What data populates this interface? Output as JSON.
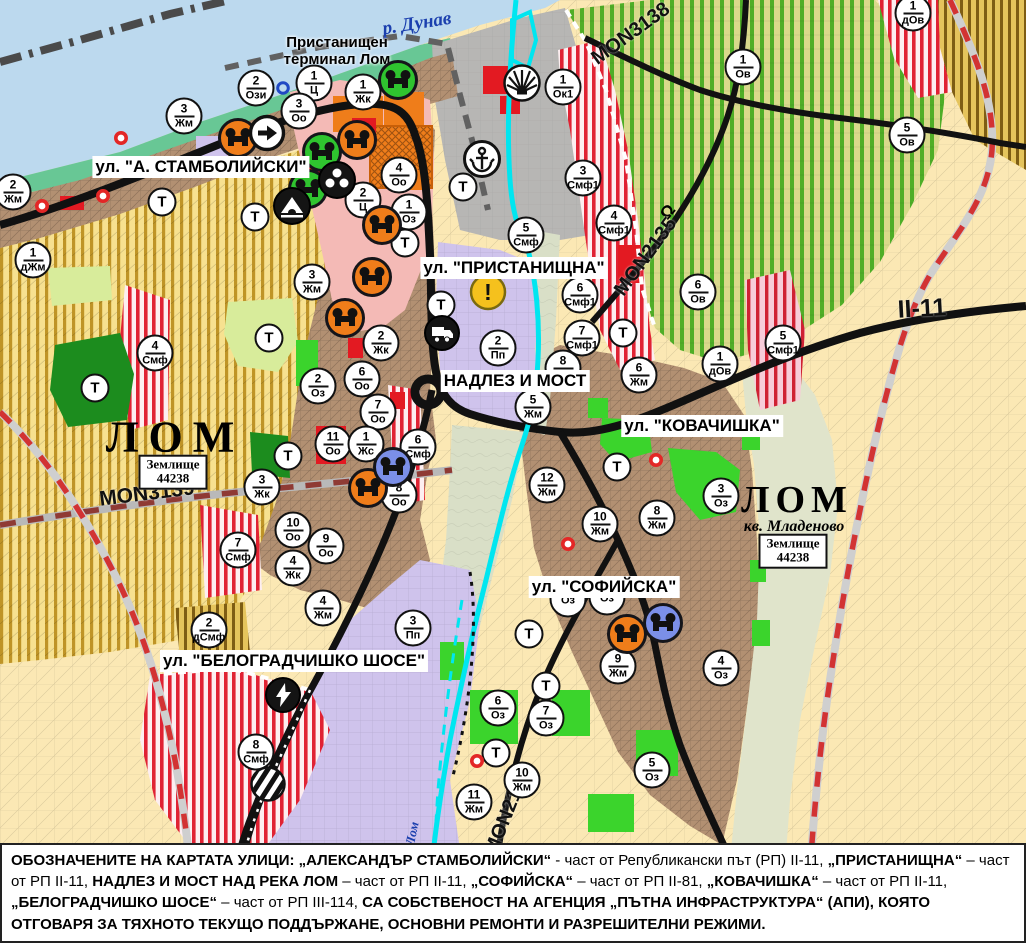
{
  "colors": {
    "water": "#bcd9ee",
    "coast": "#68c795",
    "port_gray": "#b7b6b4",
    "urban_brown": "#b29072",
    "pink_center": "#f4bab6",
    "violet_industrial": "#cfc3ec",
    "farm_cream": "#fbe8b4",
    "yellow_stripe": "#bf9427",
    "green_stripe": "#4fae27",
    "red_stripe": "#e02233",
    "bright_green": "#3bd42c",
    "dark_green": "#1c8c1e",
    "river_cyan": "#00e6f0",
    "road_black": "#111111",
    "red_solid": "#e31a22",
    "orange": "#ef7d1a",
    "warning_yellow": "#f5c11d",
    "marker_border": "#111111",
    "river_label_blue": "#1b3fae"
  },
  "map": {
    "street_labels": [
      {
        "text": "ул. \"А. СТАМБОЛИЙСКИ\"",
        "x": 201,
        "y": 167
      },
      {
        "text": "ул. \"ПРИСТАНИЩНА\"",
        "x": 514,
        "y": 268
      },
      {
        "text": "НАДЛЕЗ И МОСТ",
        "x": 515,
        "y": 381
      },
      {
        "text": "ул. \"КОВАЧИШКА\"",
        "x": 702,
        "y": 426
      },
      {
        "text": "ул. \"СОФИЙСКА\"",
        "x": 604,
        "y": 587
      },
      {
        "text": "ул. \"БЕЛОГРАДЧИШКО ШОСЕ\"",
        "x": 294,
        "y": 661
      }
    ],
    "place_labels": [
      {
        "text": "р. Дунав",
        "x": 417,
        "y": 24,
        "rot": -9,
        "cls": "pl-river",
        "name": "danube-river-label"
      },
      {
        "text": "Пристанищен\nтерминал Лом",
        "x": 337,
        "y": 51,
        "rot": 0,
        "cls": "pl-terminal",
        "name": "port-terminal-label"
      },
      {
        "text": "ЛОМ",
        "x": 175,
        "y": 437,
        "rot": 0,
        "cls": "pl-city",
        "fs": 44,
        "ls": 10,
        "name": "lom-city-label-west"
      },
      {
        "text": "ЛОМ",
        "x": 797,
        "y": 500,
        "rot": 0,
        "cls": "pl-city",
        "fs": 38,
        "ls": 6,
        "name": "lom-city-label-east"
      },
      {
        "text": "кв. Младеново",
        "x": 794,
        "y": 527,
        "rot": 0,
        "cls": "pl-suburb",
        "name": "mladenovo-quarter-label"
      },
      {
        "text": "р. Лом",
        "x": 411,
        "y": 840,
        "rot": -78,
        "cls": "pl-riverv",
        "name": "lom-river-label"
      },
      {
        "text": "Ω",
        "x": 668,
        "y": 212,
        "rot": -50,
        "cls": "pl-bridgesym",
        "name": "bridge-symbol"
      }
    ],
    "land_boxes": [
      {
        "line1": "Землище",
        "line2": "44238",
        "x": 173,
        "y": 472
      },
      {
        "line1": "Землище",
        "line2": "44238",
        "x": 793,
        "y": 551
      }
    ],
    "road_labels": [
      {
        "text": "MON3138",
        "x": 631,
        "y": 34,
        "rot": -36,
        "fs": 20
      },
      {
        "text": "MON2135",
        "x": 646,
        "y": 257,
        "rot": -54,
        "fs": 20
      },
      {
        "text": "MON3139",
        "x": 147,
        "y": 494,
        "rot": -7,
        "fs": 21
      },
      {
        "text": "MON2136",
        "x": 508,
        "y": 812,
        "rot": -68,
        "fs": 20
      },
      {
        "text": "II-11",
        "x": 922,
        "y": 309,
        "rot": -3,
        "fs": 25
      }
    ],
    "t_label": "Т",
    "zone_markers": [
      {
        "n": "2",
        "c": "Ози",
        "x": 256,
        "y": 88
      },
      {
        "n": "1",
        "c": "Ц",
        "x": 314,
        "y": 83
      },
      {
        "n": "1",
        "c": "Жк",
        "x": 363,
        "y": 92
      },
      {
        "n": "3",
        "c": "Оо",
        "x": 299,
        "y": 111
      },
      {
        "n": "1",
        "c": "Ок1",
        "x": 563,
        "y": 87
      },
      {
        "n": "3",
        "c": "Жм",
        "x": 184,
        "y": 116
      },
      {
        "n": "2",
        "c": "Жм",
        "x": 13,
        "y": 192
      },
      {
        "n": "1",
        "c": "дЖм",
        "x": 33,
        "y": 260
      },
      {
        "n": "4",
        "c": "Оо",
        "x": 399,
        "y": 175
      },
      {
        "n": "2",
        "c": "Ц",
        "x": 363,
        "y": 200
      },
      {
        "n": "1",
        "c": "Оз",
        "x": 409,
        "y": 212
      },
      {
        "n": "3",
        "c": "Жм",
        "x": 312,
        "y": 282
      },
      {
        "n": "5",
        "c": "Смф",
        "x": 526,
        "y": 235
      },
      {
        "n": "3",
        "c": "Смф1",
        "x": 583,
        "y": 178
      },
      {
        "n": "4",
        "c": "Смф1",
        "x": 614,
        "y": 223
      },
      {
        "n": "1",
        "c": "Ов",
        "x": 743,
        "y": 67
      },
      {
        "n": "5",
        "c": "Ов",
        "x": 907,
        "y": 135
      },
      {
        "n": "1",
        "c": "дОв",
        "x": 913,
        "y": 13
      },
      {
        "n": "6",
        "c": "Ов",
        "x": 698,
        "y": 292
      },
      {
        "n": "1",
        "c": "дОв",
        "x": 720,
        "y": 364
      },
      {
        "n": "5",
        "c": "Смф1",
        "x": 783,
        "y": 343
      },
      {
        "n": "6",
        "c": "Смф1",
        "x": 580,
        "y": 295
      },
      {
        "n": "7",
        "c": "Смф1",
        "x": 582,
        "y": 338
      },
      {
        "n": "8",
        "c": "Жм",
        "x": 563,
        "y": 368
      },
      {
        "n": "6",
        "c": "Жм",
        "x": 639,
        "y": 375
      },
      {
        "n": "5",
        "c": "Жм",
        "x": 533,
        "y": 407
      },
      {
        "n": "2",
        "c": "Пп",
        "x": 498,
        "y": 348
      },
      {
        "n": "4",
        "c": "Смф",
        "x": 155,
        "y": 353
      },
      {
        "n": "2",
        "c": "Жк",
        "x": 381,
        "y": 343
      },
      {
        "n": "2",
        "c": "Оз",
        "x": 318,
        "y": 386
      },
      {
        "n": "6",
        "c": "Оо",
        "x": 362,
        "y": 379
      },
      {
        "n": "7",
        "c": "Оо",
        "x": 378,
        "y": 412
      },
      {
        "n": "11",
        "c": "Оо",
        "x": 333,
        "y": 444
      },
      {
        "n": "1",
        "c": "Жс",
        "x": 366,
        "y": 444
      },
      {
        "n": "6",
        "c": "Смф",
        "x": 418,
        "y": 447
      },
      {
        "n": "8",
        "c": "Оо",
        "x": 399,
        "y": 495
      },
      {
        "n": "3",
        "c": "Жк",
        "x": 262,
        "y": 487
      },
      {
        "n": "10",
        "c": "Оо",
        "x": 293,
        "y": 530
      },
      {
        "n": "9",
        "c": "Оо",
        "x": 326,
        "y": 546
      },
      {
        "n": "4",
        "c": "Жк",
        "x": 293,
        "y": 568
      },
      {
        "n": "7",
        "c": "Смф",
        "x": 238,
        "y": 550
      },
      {
        "n": "4",
        "c": "Жм",
        "x": 323,
        "y": 608
      },
      {
        "n": "2",
        "c": "дСмф",
        "x": 209,
        "y": 630
      },
      {
        "n": "3",
        "c": "Пп",
        "x": 413,
        "y": 628
      },
      {
        "n": "8",
        "c": "Смф",
        "x": 256,
        "y": 752
      },
      {
        "n": "12",
        "c": "Жм",
        "x": 547,
        "y": 485
      },
      {
        "n": "10",
        "c": "Жм",
        "x": 600,
        "y": 524
      },
      {
        "n": "8",
        "c": "Жм",
        "x": 657,
        "y": 518
      },
      {
        "n": "3",
        "c": "Оз",
        "x": 721,
        "y": 496
      },
      {
        "n": "6",
        "c": "Оз",
        "x": 498,
        "y": 708
      },
      {
        "n": "7",
        "c": "Оз",
        "x": 546,
        "y": 718
      },
      {
        "n": "9",
        "c": "Жм",
        "x": 618,
        "y": 666
      },
      {
        "n": "4",
        "c": "Оз",
        "x": 721,
        "y": 668
      },
      {
        "n": "5",
        "c": "Оз",
        "x": 652,
        "y": 770
      },
      {
        "n": "10",
        "c": "Жм",
        "x": 522,
        "y": 780
      },
      {
        "n": "11",
        "c": "Жм",
        "x": 474,
        "y": 802
      },
      {
        "n": "",
        "c": "Оз",
        "x": 568,
        "y": 599
      },
      {
        "n": "",
        "c": "Оз",
        "x": 607,
        "y": 597
      }
    ],
    "t_markers": [
      {
        "x": 162,
        "y": 202
      },
      {
        "x": 255,
        "y": 217
      },
      {
        "x": 269,
        "y": 338
      },
      {
        "x": 95,
        "y": 388
      },
      {
        "x": 288,
        "y": 456
      },
      {
        "x": 405,
        "y": 243
      },
      {
        "x": 463,
        "y": 187
      },
      {
        "x": 441,
        "y": 305
      },
      {
        "x": 623,
        "y": 333
      },
      {
        "x": 617,
        "y": 467
      },
      {
        "x": 529,
        "y": 634
      },
      {
        "x": 546,
        "y": 686
      },
      {
        "x": 496,
        "y": 753
      }
    ],
    "poi_icons": [
      {
        "name": "culture-monument-icon",
        "glyph": "culture",
        "fill": "#ef7d1a",
        "x": 238,
        "y": 138
      },
      {
        "name": "culture-monument-icon",
        "glyph": "culture",
        "fill": "#ef7d1a",
        "x": 357,
        "y": 140
      },
      {
        "name": "culture-monument-icon",
        "glyph": "culture",
        "fill": "#ef7d1a",
        "x": 382,
        "y": 225
      },
      {
        "name": "culture-monument-icon",
        "glyph": "culture",
        "fill": "#ef7d1a",
        "x": 372,
        "y": 277
      },
      {
        "name": "culture-monument-icon",
        "glyph": "culture",
        "fill": "#ef7d1a",
        "x": 345,
        "y": 318
      },
      {
        "name": "culture-monument-icon",
        "glyph": "culture",
        "fill": "#ef7d1a",
        "x": 368,
        "y": 488
      },
      {
        "name": "culture-monument-icon",
        "glyph": "culture",
        "fill": "#ef7d1a",
        "x": 627,
        "y": 634
      },
      {
        "name": "culture-monument-icon",
        "glyph": "culture",
        "fill": "#2fc42f",
        "x": 398,
        "y": 80
      },
      {
        "name": "culture-monument-icon",
        "glyph": "culture",
        "fill": "#2fc42f",
        "x": 322,
        "y": 152
      },
      {
        "name": "culture-monument-icon",
        "glyph": "culture",
        "fill": "#2fc42f",
        "x": 308,
        "y": 189
      },
      {
        "name": "culture-monument-icon",
        "glyph": "culture",
        "fill": "#7b8fe8",
        "x": 393,
        "y": 467
      },
      {
        "name": "culture-monument-icon",
        "glyph": "culture",
        "fill": "#7b8fe8",
        "x": 663,
        "y": 623
      },
      {
        "name": "people-group-icon",
        "glyph": "people",
        "fill": "#141414",
        "x": 337,
        "y": 180
      },
      {
        "name": "cave-monument-icon",
        "glyph": "cave",
        "fill": "#141414",
        "x": 292,
        "y": 206
      },
      {
        "name": "one-way-arrow-icon",
        "glyph": "arrow",
        "fill": "#ffffff",
        "x": 267,
        "y": 133
      },
      {
        "name": "port-anchor-icon",
        "glyph": "anchor",
        "fill": "#ffffff",
        "x": 482,
        "y": 159
      },
      {
        "name": "lighthouse-rays-icon",
        "glyph": "rays",
        "fill": "#ffffff",
        "x": 522,
        "y": 83
      },
      {
        "name": "warning-icon",
        "glyph": "warning",
        "fill": "#f5c11d",
        "x": 488,
        "y": 292,
        "label": "!"
      },
      {
        "name": "truck-terminal-icon",
        "glyph": "truck",
        "fill": "#141414",
        "x": 442,
        "y": 333
      },
      {
        "name": "power-station-icon",
        "glyph": "lightning",
        "fill": "#141414",
        "x": 283,
        "y": 695
      },
      {
        "name": "railway-crossing-icon",
        "glyph": "railcross",
        "fill": "#ffffff",
        "x": 268,
        "y": 784
      },
      {
        "name": "point-of-interest-dot-icon",
        "glyph": "reddot",
        "fill": "#e32726",
        "x": 121,
        "y": 138
      },
      {
        "name": "point-of-interest-dot-icon",
        "glyph": "reddot",
        "fill": "#e32726",
        "x": 103,
        "y": 196
      },
      {
        "name": "point-of-interest-dot-icon",
        "glyph": "reddot",
        "fill": "#e32726",
        "x": 42,
        "y": 206
      },
      {
        "name": "point-of-interest-dot-icon",
        "glyph": "reddot",
        "fill": "#e32726",
        "x": 656,
        "y": 460
      },
      {
        "name": "point-of-interest-dot-icon",
        "glyph": "reddot",
        "fill": "#e32726",
        "x": 568,
        "y": 544
      },
      {
        "name": "point-of-interest-dot-icon",
        "glyph": "reddot",
        "fill": "#e32726",
        "x": 477,
        "y": 761
      },
      {
        "name": "blue-ring-icon",
        "glyph": "bluering",
        "fill": "#2149c4",
        "x": 283,
        "y": 88
      }
    ]
  },
  "caption": {
    "segments": [
      {
        "t": "ОБОЗНАЧЕНИТЕ НА КАРТАТА УЛИЦИ: ",
        "b": 1
      },
      {
        "t": "„АЛЕКСАНДЪР СТАМБОЛИЙСКИ“",
        "b": 1
      },
      {
        "t": " - част от Републикански път (РП) II-11, ",
        "b": 0
      },
      {
        "t": "„ПРИСТАНИЩНА“",
        "b": 1
      },
      {
        "t": " – част от РП II-11, ",
        "b": 0
      },
      {
        "t": "НАДЛЕЗ И МОСТ НАД РЕКА ЛОМ",
        "b": 1
      },
      {
        "t": " – част от РП II-11, ",
        "b": 0
      },
      {
        "t": "„СОФИЙСКА“",
        "b": 1
      },
      {
        "t": " – част от РП II-81, ",
        "b": 0
      },
      {
        "t": "„КОВАЧИШКА“",
        "b": 1
      },
      {
        "t": " – част от РП II-11, ",
        "b": 0
      },
      {
        "t": "„БЕЛОГРАДЧИШКО ШОСЕ“",
        "b": 1
      },
      {
        "t": " – част от РП III-114, ",
        "b": 0
      },
      {
        "t": "СА СОБСТВЕНОСТ НА АГЕНЦИЯ „ПЪТНА ИНФРАСТРУКТУРА“ (АПИ), КОЯТО ОТГОВАРЯ ЗА ТЯХНОТО ТЕКУЩО ПОДДЪРЖАНЕ, ОСНОВНИ РЕМОНТИ И РАЗРЕШИТЕЛНИ РЕЖИМИ.",
        "b": 1
      }
    ]
  }
}
